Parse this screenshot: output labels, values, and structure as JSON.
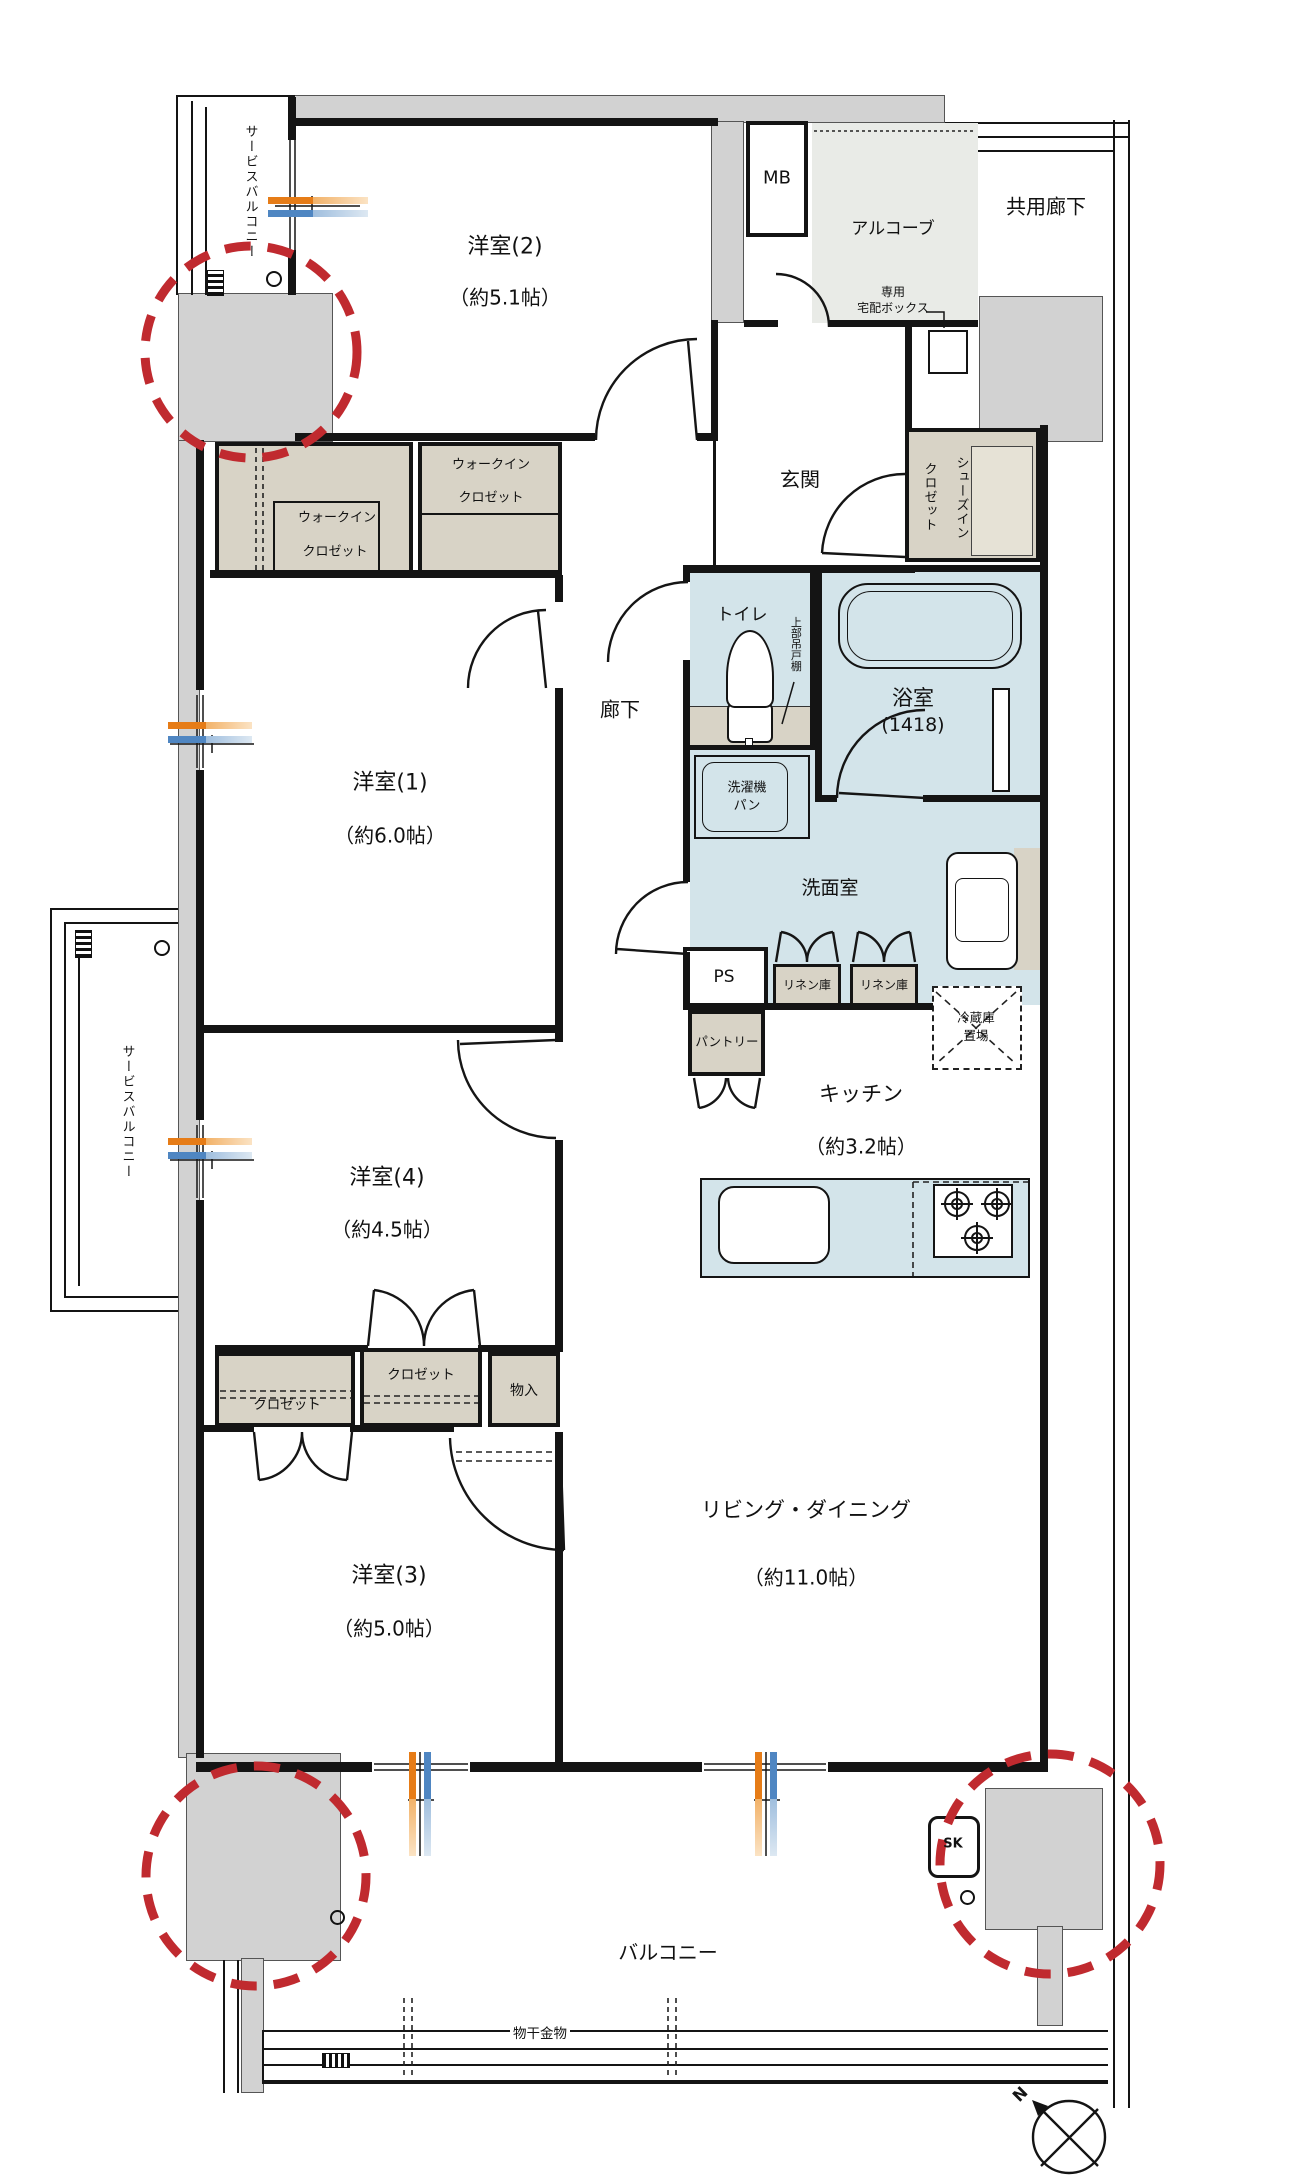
{
  "plan_type": "apartment-floor-plan",
  "rooms": {
    "western2": {
      "name": "洋室(2)",
      "size": "（約5.1帖）"
    },
    "western1": {
      "name": "洋室(1)",
      "size": "（約6.0帖）"
    },
    "western4": {
      "name": "洋室(4)",
      "size": "（約4.5帖）"
    },
    "western3": {
      "name": "洋室(3)",
      "size": "（約5.0帖）"
    },
    "living_dining": {
      "name": "リビング・ダイニング",
      "size": "（約11.0帖）"
    },
    "kitchen": {
      "name": "キッチン",
      "size": "（約3.2帖）"
    },
    "bath": {
      "name": "浴室",
      "size": "(1418)"
    },
    "washroom": {
      "name": "洗面室"
    },
    "toilet": {
      "name": "トイレ"
    },
    "entrance": {
      "name": "玄関"
    },
    "hallway": {
      "name": "廊下"
    }
  },
  "labels": {
    "service_balcony": "サービスバルコニー",
    "balcony": "バルコニー",
    "common_corridor": "共用廊下",
    "alcove": "アルコーブ",
    "meter_box": "MB",
    "delivery_line1": "専用",
    "delivery_line2": "宅配ボックス",
    "shoes_closet_line1": "シューズイン",
    "shoes_closet_line2": "クロゼット",
    "wic_line1": "ウォークイン",
    "wic_line2": "クロゼット",
    "upper_cabinet": "上部吊戸棚",
    "washer_pan_line1": "洗濯機",
    "washer_pan_line2": "パン",
    "pipe_space": "PS",
    "pantry": "パントリー",
    "linen": "リネン庫",
    "fridge_line1": "冷蔵庫",
    "fridge_line2": "置場",
    "closet": "クロゼット",
    "storage": "物入",
    "slop_sink": "SK",
    "laundry_hardware": "物干金物",
    "compass_north": "N"
  },
  "colors": {
    "wall": "#141414",
    "concrete_gray": "#d2d2d2",
    "alcove_gray": "#e9ebe7",
    "water_blue": "#d3e4ea",
    "closet_beige": "#d8d3c6",
    "highlight_red": "#c02a2f",
    "window_orange": "#e67c17",
    "window_blue": "#4f86c2"
  }
}
